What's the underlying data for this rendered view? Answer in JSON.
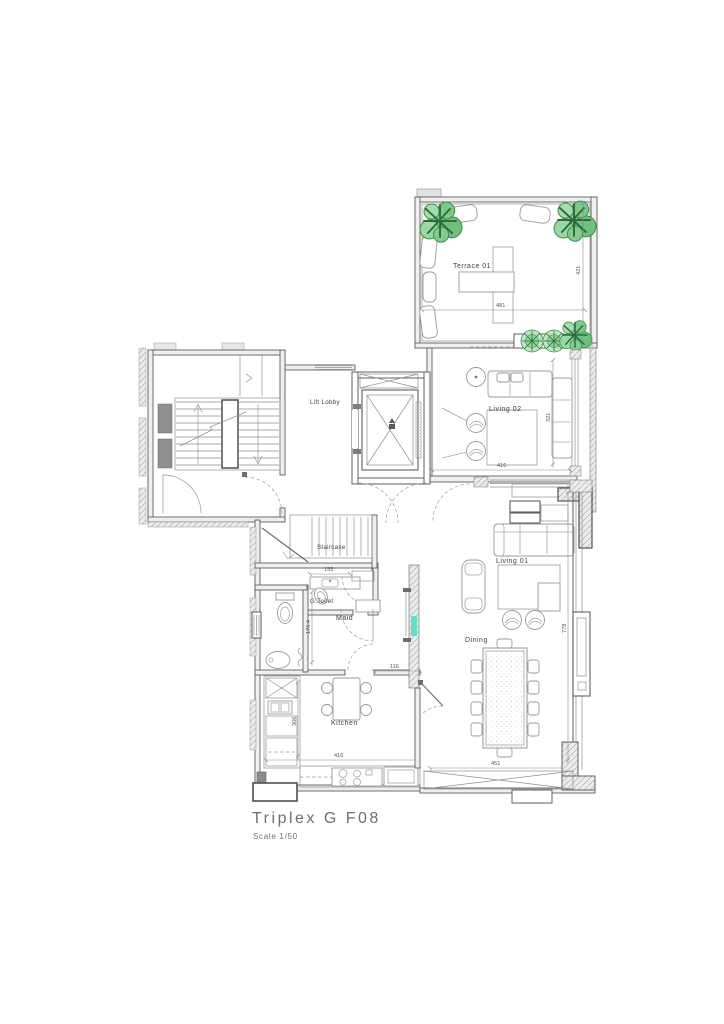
{
  "title": {
    "name": "Triplex G F08",
    "scale": "Scale 1/50"
  },
  "rooms": {
    "terrace": "Terrace 01",
    "living2": "Living 02",
    "lift_lobby": "Lift Lobby",
    "staircase": "Staircase",
    "g_toilet": "G.Toilet",
    "maid": "Maid",
    "kitchen": "Kitchen",
    "dining": "Dining",
    "living1": "Living 01"
  },
  "dimensions": {
    "terrace_width": "481",
    "terrace_height": "421",
    "living2_width": "416",
    "living2_height": "321",
    "stair_width": "155",
    "maid_height": "170.4",
    "kitchen_top": "116",
    "kitchen_height": "306",
    "kitchen_width": "416",
    "dining_width": "451",
    "right_height": "778"
  },
  "colors": {
    "line": "#5f5f5f",
    "plant_green": "#6fbf7d",
    "accent_cyan": "#45e0c4"
  }
}
